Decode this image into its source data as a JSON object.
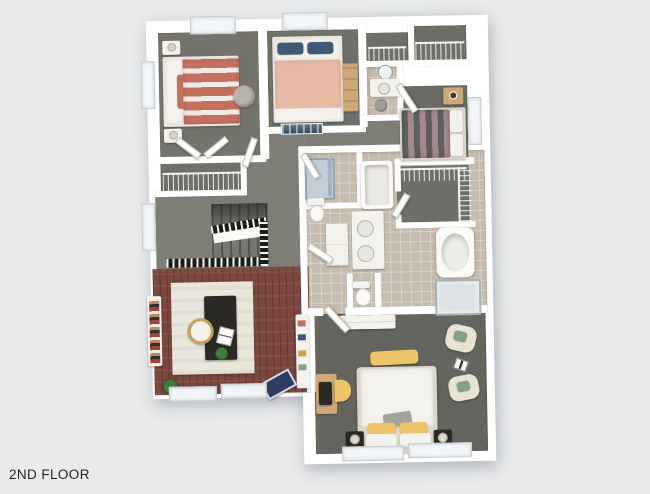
{
  "floor_label": "2ND FLOOR",
  "colors": {
    "bg": "#e9ebec",
    "wall": "#ffffff",
    "text": "#1f2023",
    "window": "#f3f6f8",
    "carpet1": "#74746c",
    "carpet2": "#70706a",
    "carpet3": "#6b6b65",
    "carpet-hall": "#7e7e76",
    "carpet-master": "#65655f",
    "carpet-closet": "#6f6f69",
    "tile": "#c6bcae",
    "wood": "#7b463c",
    "rug": "#eae6db",
    "bedding-coral": "#c4705e",
    "bedding-peach": "#e7bca6",
    "bedding-mauve": "#a5888f",
    "bedding-dark": "#5f5f5d",
    "pillow-navy": "#3d5a78",
    "accent-yellow": "#edc468",
    "accent-green": "#87a083",
    "chair-cream": "#e8e2d4",
    "furniture-dark": "#2b2924",
    "furniture-white": "#f4f2ec",
    "wood-light": "#cfa878",
    "railing": "#1d1d1b",
    "shower-glass": "#9db4c6",
    "plant": "#3f7d3a",
    "mat-blue": "#2e3c63",
    "art-navy": "#2f4a5c",
    "hamper-gray": "#a09d95",
    "ottoman-gray": "#b7b4ac"
  }
}
